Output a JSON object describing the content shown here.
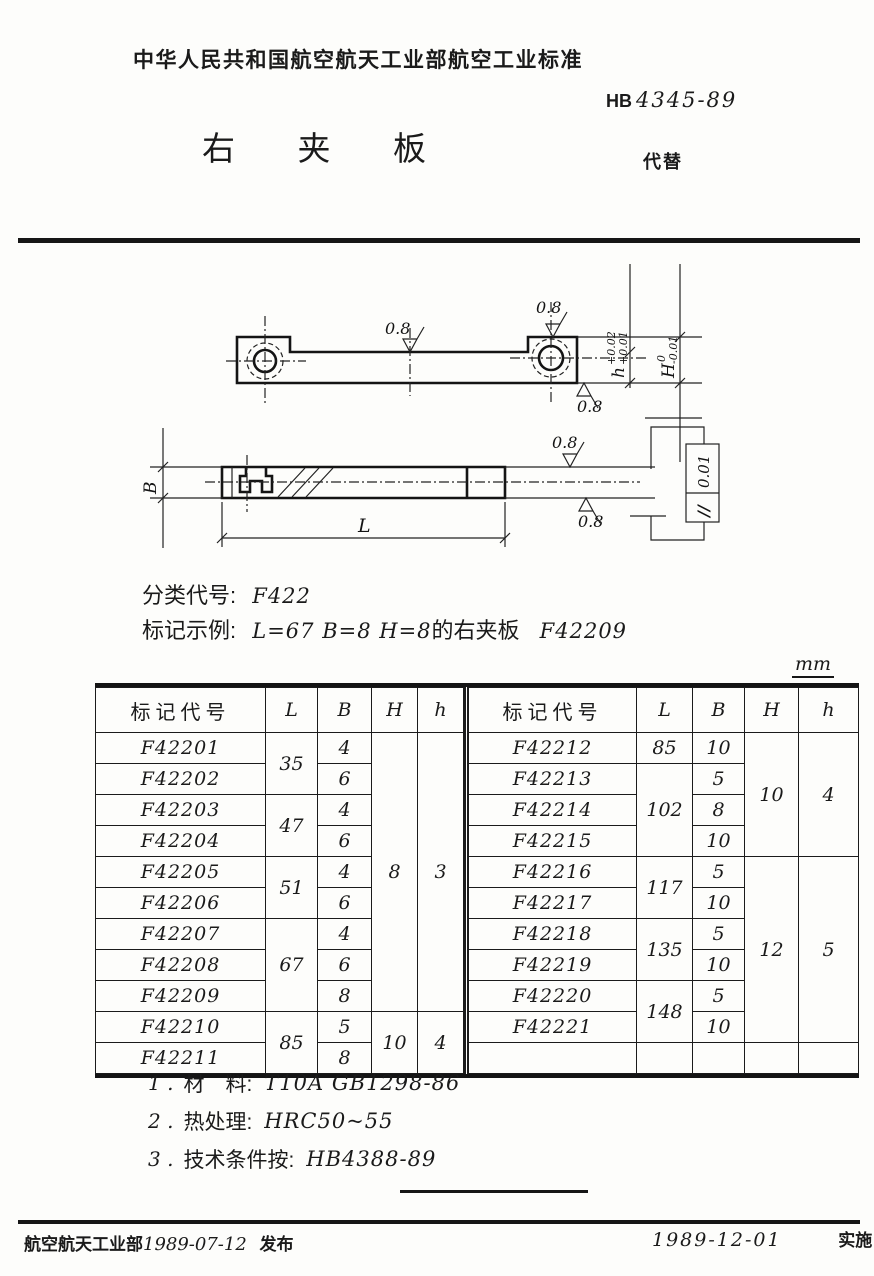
{
  "header": {
    "org_standard": "中华人民共和国航空航天工业部航空工业标准",
    "code_prefix": "HB",
    "code_number": "4345-89",
    "title": "右 夹 板",
    "replaces": "代替"
  },
  "drawing": {
    "surface_finish": "0.8",
    "dims": {
      "h": "h",
      "h_tol_upper": "+0.02",
      "h_tol_lower": "+0.01",
      "H": "H",
      "H_tol_upper": "0",
      "H_tol_lower": "-0.01",
      "B": "B",
      "L": "L"
    },
    "tolerance_frame": {
      "symbol": "//",
      "value": "0.01"
    }
  },
  "classification": {
    "label": "分类代号:",
    "value": "F422"
  },
  "marking_example": {
    "label": "标记示例:",
    "value_dims": "L=67  B=8  H=8",
    "value_mid": "的右夹板",
    "value_code": "F42209"
  },
  "table": {
    "unit": "mm",
    "headers": [
      "标记代号",
      "L",
      "B",
      "H",
      "h"
    ],
    "left_rows": [
      [
        {
          "v": "F42201"
        },
        {
          "v": "35",
          "rs": 2
        },
        {
          "v": "4"
        },
        {
          "v": "8",
          "rs": 9
        },
        {
          "v": "3",
          "rs": 9
        }
      ],
      [
        {
          "v": "F42202"
        },
        {
          "v": "6"
        }
      ],
      [
        {
          "v": "F42203"
        },
        {
          "v": "47",
          "rs": 2
        },
        {
          "v": "4"
        }
      ],
      [
        {
          "v": "F42204"
        },
        {
          "v": "6"
        }
      ],
      [
        {
          "v": "F42205"
        },
        {
          "v": "51",
          "rs": 2
        },
        {
          "v": "4"
        }
      ],
      [
        {
          "v": "F42206"
        },
        {
          "v": "6"
        }
      ],
      [
        {
          "v": "F42207"
        },
        {
          "v": "67",
          "rs": 3
        },
        {
          "v": "4"
        }
      ],
      [
        {
          "v": "F42208"
        },
        {
          "v": "6"
        }
      ],
      [
        {
          "v": "F42209"
        },
        {
          "v": "8"
        }
      ],
      [
        {
          "v": "F42210"
        },
        {
          "v": "85",
          "rs": 2
        },
        {
          "v": "5"
        },
        {
          "v": "10",
          "rs": 2
        },
        {
          "v": "4",
          "rs": 2
        }
      ],
      [
        {
          "v": "F42211"
        },
        {
          "v": "8"
        }
      ]
    ],
    "right_rows": [
      [
        {
          "v": "F42212"
        },
        {
          "v": "85"
        },
        {
          "v": "10"
        },
        {
          "v": "10",
          "rs": 4
        },
        {
          "v": "4",
          "rs": 4
        }
      ],
      [
        {
          "v": "F42213"
        },
        {
          "v": "102",
          "rs": 3
        },
        {
          "v": "5"
        }
      ],
      [
        {
          "v": "F42214"
        },
        {
          "v": "8"
        }
      ],
      [
        {
          "v": "F42215"
        },
        {
          "v": "10"
        }
      ],
      [
        {
          "v": "F42216"
        },
        {
          "v": "117",
          "rs": 2
        },
        {
          "v": "5"
        },
        {
          "v": "12",
          "rs": 6
        },
        {
          "v": "5",
          "rs": 6
        }
      ],
      [
        {
          "v": "F42217"
        },
        {
          "v": "10"
        }
      ],
      [
        {
          "v": "F42218"
        },
        {
          "v": "135",
          "rs": 2
        },
        {
          "v": "5"
        }
      ],
      [
        {
          "v": "F42219"
        },
        {
          "v": "10"
        }
      ],
      [
        {
          "v": "F42220"
        },
        {
          "v": "148",
          "rs": 2
        },
        {
          "v": "5"
        }
      ],
      [
        {
          "v": "F42221"
        },
        {
          "v": "10"
        }
      ],
      [
        {
          "v": ""
        },
        {
          "v": ""
        },
        {
          "v": ""
        },
        {
          "v": ""
        },
        {
          "v": ""
        }
      ]
    ]
  },
  "notes": [
    {
      "no": "1 .",
      "label": "材　料:",
      "value": "T10A  GB1298-86"
    },
    {
      "no": "2 .",
      "label": "热处理:",
      "value": "HRC50~55"
    },
    {
      "no": "3 .",
      "label": "技术条件按:",
      "value": "HB4388-89"
    }
  ],
  "footer": {
    "issue_org": "航空航天工业部",
    "issue_date": "1989-07-12",
    "issue_label": "发布",
    "impl_date": "1989-12-01",
    "impl_label": "实施"
  }
}
